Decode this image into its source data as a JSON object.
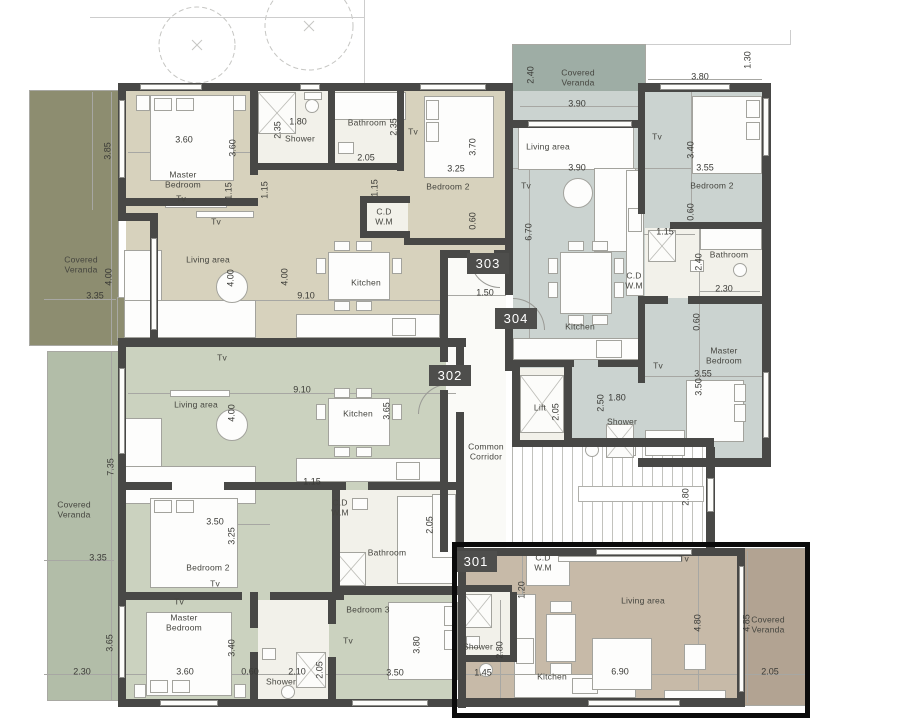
{
  "colors": {
    "wall": "#484846",
    "unit_303": "#d7d2bd",
    "unit_304": "#cbd3d0",
    "unit_302": "#cbd2bf",
    "unit_301": "#c7baa8",
    "veranda_olive": "#8d8d70",
    "veranda_green": "#b2bda8",
    "veranda_gray": "#9eada5",
    "veranda_tan": "#b2a392",
    "white_room": "#f2f1ea",
    "corridor": "#fafaf7",
    "badge_bg": "#4e4e4c",
    "badge_text": "#ffffff",
    "highlight_301": "#0b0b0b"
  },
  "unit_badges": [
    {
      "label": "303",
      "x": 467,
      "y": 253
    },
    {
      "label": "304",
      "x": 495,
      "y": 308
    },
    {
      "label": "302",
      "x": 429,
      "y": 365
    },
    {
      "label": "301",
      "x": 455,
      "y": 551
    }
  ],
  "room_labels": [
    {
      "text": "Covered\nVeranda",
      "x": 81,
      "y": 265
    },
    {
      "text": "Master\nBedroom",
      "x": 183,
      "y": 180
    },
    {
      "text": "Tv",
      "x": 181,
      "y": 199
    },
    {
      "text": "Shower",
      "x": 300,
      "y": 139
    },
    {
      "text": "Bathroom",
      "x": 367,
      "y": 123
    },
    {
      "text": "Tv",
      "x": 413,
      "y": 132
    },
    {
      "text": "Bedroom 2",
      "x": 448,
      "y": 187
    },
    {
      "text": "C.D\nW.M",
      "x": 384,
      "y": 217
    },
    {
      "text": "Living area",
      "x": 208,
      "y": 260
    },
    {
      "text": "Tv",
      "x": 216,
      "y": 222
    },
    {
      "text": "Kitchen",
      "x": 366,
      "y": 283
    },
    {
      "text": "Covered\nVeranda",
      "x": 578,
      "y": 78
    },
    {
      "text": "Living area",
      "x": 548,
      "y": 147
    },
    {
      "text": "Tv",
      "x": 657,
      "y": 137
    },
    {
      "text": "Bedroom 2",
      "x": 712,
      "y": 186
    },
    {
      "text": "Tv",
      "x": 526,
      "y": 186
    },
    {
      "text": "Bathroom",
      "x": 729,
      "y": 255
    },
    {
      "text": "C.D\nW.M",
      "x": 634,
      "y": 281
    },
    {
      "text": "Kitchen",
      "x": 580,
      "y": 327
    },
    {
      "text": "Master\nBedroom",
      "x": 724,
      "y": 356
    },
    {
      "text": "Tv",
      "x": 658,
      "y": 366
    },
    {
      "text": "Lift",
      "x": 540,
      "y": 408
    },
    {
      "text": "Shower",
      "x": 622,
      "y": 422
    },
    {
      "text": "Common\nCorridor",
      "x": 486,
      "y": 452
    },
    {
      "text": "Covered\nVeranda",
      "x": 74,
      "y": 510
    },
    {
      "text": "Living area",
      "x": 196,
      "y": 405
    },
    {
      "text": "Kitchen",
      "x": 358,
      "y": 414
    },
    {
      "text": "Tv",
      "x": 222,
      "y": 358
    },
    {
      "text": "C.D\nW.M",
      "x": 340,
      "y": 508
    },
    {
      "text": "Bathroom",
      "x": 387,
      "y": 553
    },
    {
      "text": "Bedroom 2",
      "x": 208,
      "y": 568
    },
    {
      "text": "Tv",
      "x": 215,
      "y": 584
    },
    {
      "text": "Tv",
      "x": 179,
      "y": 602
    },
    {
      "text": "Master\nBedroom",
      "x": 184,
      "y": 623
    },
    {
      "text": "Shower",
      "x": 281,
      "y": 682
    },
    {
      "text": "Bedroom 3",
      "x": 368,
      "y": 610
    },
    {
      "text": "Tv",
      "x": 348,
      "y": 641
    },
    {
      "text": "C.D\nW.M",
      "x": 543,
      "y": 563
    },
    {
      "text": "Tv",
      "x": 684,
      "y": 559
    },
    {
      "text": "Living area",
      "x": 643,
      "y": 601
    },
    {
      "text": "Shower",
      "x": 478,
      "y": 647
    },
    {
      "text": "Kitchen",
      "x": 552,
      "y": 677
    },
    {
      "text": "Covered\nVeranda",
      "x": 768,
      "y": 625
    }
  ],
  "dimension_labels": [
    {
      "text": "3.85",
      "x": 108,
      "y": 151,
      "v": true
    },
    {
      "text": "3.60",
      "x": 184,
      "y": 140,
      "v": false
    },
    {
      "text": "3.60",
      "x": 233,
      "y": 148,
      "v": true
    },
    {
      "text": "1.15",
      "x": 229,
      "y": 191,
      "v": true
    },
    {
      "text": "1.15",
      "x": 265,
      "y": 190,
      "v": true
    },
    {
      "text": "2.35",
      "x": 278,
      "y": 130,
      "v": true
    },
    {
      "text": "1.80",
      "x": 298,
      "y": 122,
      "v": false
    },
    {
      "text": "2.35",
      "x": 394,
      "y": 127,
      "v": true
    },
    {
      "text": "2.05",
      "x": 366,
      "y": 158,
      "v": false
    },
    {
      "text": "3.70",
      "x": 473,
      "y": 147,
      "v": true
    },
    {
      "text": "3.25",
      "x": 456,
      "y": 169,
      "v": false
    },
    {
      "text": "1.15",
      "x": 375,
      "y": 188,
      "v": true
    },
    {
      "text": "0.60",
      "x": 473,
      "y": 221,
      "v": true
    },
    {
      "text": "4.00",
      "x": 109,
      "y": 277,
      "v": true
    },
    {
      "text": "3.35",
      "x": 95,
      "y": 296,
      "v": false
    },
    {
      "text": "4.00",
      "x": 231,
      "y": 278,
      "v": true
    },
    {
      "text": "4.00",
      "x": 285,
      "y": 277,
      "v": true
    },
    {
      "text": "9.10",
      "x": 306,
      "y": 296,
      "v": false
    },
    {
      "text": "1.50",
      "x": 485,
      "y": 293,
      "v": false
    },
    {
      "text": "2.40",
      "x": 531,
      "y": 75,
      "v": true
    },
    {
      "text": "3.90",
      "x": 577,
      "y": 104,
      "v": false
    },
    {
      "text": "3.80",
      "x": 700,
      "y": 77,
      "v": false
    },
    {
      "text": "1.30",
      "x": 748,
      "y": 60,
      "v": true
    },
    {
      "text": "3.40",
      "x": 691,
      "y": 150,
      "v": true
    },
    {
      "text": "3.90",
      "x": 577,
      "y": 168,
      "v": false
    },
    {
      "text": "3.55",
      "x": 705,
      "y": 168,
      "v": false
    },
    {
      "text": "6.70",
      "x": 529,
      "y": 232,
      "v": true
    },
    {
      "text": "0.60",
      "x": 691,
      "y": 212,
      "v": true
    },
    {
      "text": "1.15",
      "x": 665,
      "y": 232,
      "v": false
    },
    {
      "text": "2.40",
      "x": 699,
      "y": 262,
      "v": true
    },
    {
      "text": "2.30",
      "x": 724,
      "y": 289,
      "v": false
    },
    {
      "text": "0.60",
      "x": 697,
      "y": 322,
      "v": true
    },
    {
      "text": "3.55",
      "x": 703,
      "y": 374,
      "v": false
    },
    {
      "text": "3.50",
      "x": 699,
      "y": 387,
      "v": true
    },
    {
      "text": "2.50",
      "x": 601,
      "y": 403,
      "v": true
    },
    {
      "text": "1.80",
      "x": 617,
      "y": 398,
      "v": false
    },
    {
      "text": "2.05",
      "x": 556,
      "y": 412,
      "v": true
    },
    {
      "text": "2.80",
      "x": 686,
      "y": 497,
      "v": true
    },
    {
      "text": "7.35",
      "x": 111,
      "y": 467,
      "v": true
    },
    {
      "text": "3.35",
      "x": 98,
      "y": 558,
      "v": false
    },
    {
      "text": "9.10",
      "x": 302,
      "y": 390,
      "v": false
    },
    {
      "text": "4.00",
      "x": 232,
      "y": 413,
      "v": true
    },
    {
      "text": "3.65",
      "x": 387,
      "y": 411,
      "v": true
    },
    {
      "text": "1.15",
      "x": 312,
      "y": 482,
      "v": false
    },
    {
      "text": "3.50",
      "x": 215,
      "y": 522,
      "v": false
    },
    {
      "text": "3.25",
      "x": 232,
      "y": 536,
      "v": true
    },
    {
      "text": "2.05",
      "x": 430,
      "y": 525,
      "v": true
    },
    {
      "text": "3.65",
      "x": 110,
      "y": 643,
      "v": true
    },
    {
      "text": "3.40",
      "x": 232,
      "y": 648,
      "v": true
    },
    {
      "text": "2.30",
      "x": 82,
      "y": 672,
      "v": false
    },
    {
      "text": "3.60",
      "x": 185,
      "y": 672,
      "v": false
    },
    {
      "text": "0.60",
      "x": 250,
      "y": 672,
      "v": false
    },
    {
      "text": "2.10",
      "x": 297,
      "y": 672,
      "v": false
    },
    {
      "text": "2.05",
      "x": 320,
      "y": 670,
      "v": true
    },
    {
      "text": "3.80",
      "x": 417,
      "y": 645,
      "v": true
    },
    {
      "text": "3.50",
      "x": 395,
      "y": 673,
      "v": false
    },
    {
      "text": "1.20",
      "x": 522,
      "y": 590,
      "v": true
    },
    {
      "text": "4.80",
      "x": 698,
      "y": 623,
      "v": true
    },
    {
      "text": "4.85",
      "x": 747,
      "y": 623,
      "v": true
    },
    {
      "text": "2.80",
      "x": 500,
      "y": 650,
      "v": true
    },
    {
      "text": "1.45",
      "x": 483,
      "y": 673,
      "v": false
    },
    {
      "text": "6.90",
      "x": 620,
      "y": 672,
      "v": false
    },
    {
      "text": "2.05",
      "x": 770,
      "y": 672,
      "v": false
    }
  ]
}
